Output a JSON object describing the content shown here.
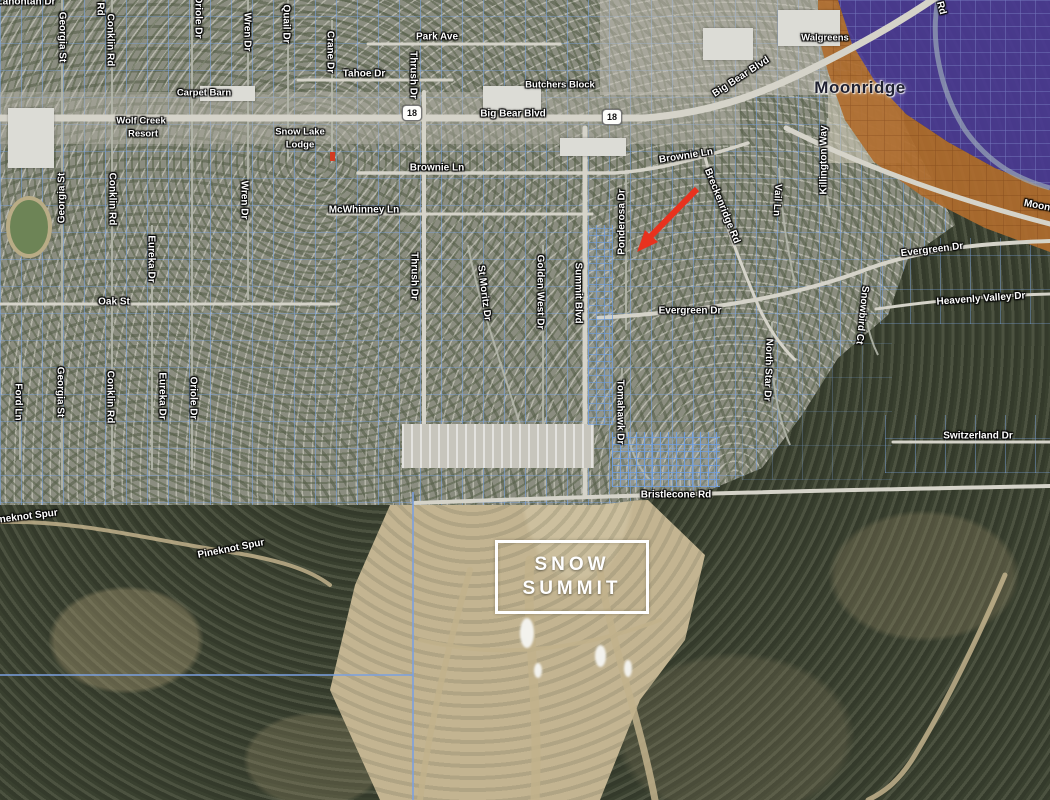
{
  "map_title": "Big Bear / Moonridge parcel map with Snow Summit",
  "colors": {
    "arrow": "#e8321e",
    "purple_zone": "#4a3a94",
    "purple_parcel_line": "#8fa0dc",
    "orange_zone": "#b06c2e",
    "orange_parcel_line": "#6b3410",
    "parcel_line": "#7aa3de",
    "boundary_line": "#7ba0e0",
    "road": "#d5d3c9",
    "label_text": "#ffffff",
    "area_label_text": "#1f2030"
  },
  "snow_summit": {
    "line1": "SNOW",
    "line2": "SUMMIT"
  },
  "highway_shields": [
    {
      "label": "18",
      "x": 412,
      "y": 113
    },
    {
      "label": "18",
      "x": 612,
      "y": 117
    }
  ],
  "labels": [
    {
      "t": "Lahontan Dr",
      "x": 26,
      "y": 2,
      "r": 0,
      "k": "street"
    },
    {
      "t": "Park Ave",
      "x": 437,
      "y": 37,
      "r": 0,
      "k": "street"
    },
    {
      "t": "Tahoe Dr",
      "x": 364,
      "y": 74,
      "r": 0,
      "k": "street"
    },
    {
      "t": "Big Bear Blvd",
      "x": 513,
      "y": 114,
      "r": 0,
      "k": "street"
    },
    {
      "t": "Big Bear Blvd",
      "x": 741,
      "y": 77,
      "r": -33,
      "k": "street"
    },
    {
      "t": "Brownie Ln",
      "x": 437,
      "y": 168,
      "r": 0,
      "k": "street"
    },
    {
      "t": "Brownie Ln",
      "x": 686,
      "y": 156,
      "r": -9,
      "k": "street"
    },
    {
      "t": "McWhinney Ln",
      "x": 364,
      "y": 210,
      "r": 0,
      "k": "street"
    },
    {
      "t": "Oak St",
      "x": 114,
      "y": 302,
      "r": 0,
      "k": "street"
    },
    {
      "t": "Evergreen Dr",
      "x": 690,
      "y": 311,
      "r": 0,
      "k": "street"
    },
    {
      "t": "Evergreen Dr",
      "x": 932,
      "y": 250,
      "r": -7,
      "k": "street"
    },
    {
      "t": "Heavenly Valley Dr",
      "x": 981,
      "y": 299,
      "r": -4,
      "k": "street"
    },
    {
      "t": "Switzerland Dr",
      "x": 978,
      "y": 436,
      "r": 0,
      "k": "street"
    },
    {
      "t": "Bristlecone Rd",
      "x": 676,
      "y": 495,
      "r": 0,
      "k": "street"
    },
    {
      "t": "Pineknot Spur",
      "x": 24,
      "y": 517,
      "r": -7,
      "k": "street"
    },
    {
      "t": "Pineknot Spur",
      "x": 231,
      "y": 549,
      "r": -11,
      "k": "street"
    },
    {
      "t": "Moonridge",
      "x": 1049,
      "y": 208,
      "r": 11,
      "k": "street"
    },
    {
      "t": "Georgia St",
      "x": 62,
      "y": 37,
      "r": 90,
      "k": "street"
    },
    {
      "t": "Conklin Rd",
      "x": 110,
      "y": 40,
      "r": 90,
      "k": "street"
    },
    {
      "t": "Rd",
      "x": 100,
      "y": 9,
      "r": 90,
      "k": "street"
    },
    {
      "t": "Oriole Dr",
      "x": 198,
      "y": 17,
      "r": 90,
      "k": "street"
    },
    {
      "t": "Wren Dr",
      "x": 247,
      "y": 32,
      "r": 90,
      "k": "street"
    },
    {
      "t": "Quail Dr",
      "x": 286,
      "y": 24,
      "r": 90,
      "k": "street"
    },
    {
      "t": "Crane Dr",
      "x": 330,
      "y": 52,
      "r": 90,
      "k": "street"
    },
    {
      "t": "Georgia St",
      "x": 62,
      "y": 198,
      "r": -90,
      "k": "street"
    },
    {
      "t": "Conklin Rd",
      "x": 112,
      "y": 199,
      "r": 90,
      "k": "street"
    },
    {
      "t": "Wren Dr",
      "x": 244,
      "y": 200,
      "r": 90,
      "k": "street"
    },
    {
      "t": "Eureka Dr",
      "x": 151,
      "y": 259,
      "r": 90,
      "k": "street"
    },
    {
      "t": "Thrush Dr",
      "x": 413,
      "y": 75,
      "r": 90,
      "k": "street"
    },
    {
      "t": "Thrush Dr",
      "x": 414,
      "y": 276,
      "r": 90,
      "k": "street"
    },
    {
      "t": "St Moritz Dr",
      "x": 484,
      "y": 293,
      "r": 83,
      "k": "street"
    },
    {
      "t": "Golden West Dr",
      "x": 540,
      "y": 292,
      "r": 90,
      "k": "street"
    },
    {
      "t": "Summit Blvd",
      "x": 578,
      "y": 293,
      "r": 90,
      "k": "street"
    },
    {
      "t": "Ponderosa Dr",
      "x": 622,
      "y": 222,
      "r": -90,
      "k": "street"
    },
    {
      "t": "Tomahawk Dr",
      "x": 620,
      "y": 412,
      "r": 90,
      "k": "street"
    },
    {
      "t": "Ford Ln",
      "x": 18,
      "y": 402,
      "r": 90,
      "k": "street"
    },
    {
      "t": "Georgia St",
      "x": 60,
      "y": 392,
      "r": 90,
      "k": "street"
    },
    {
      "t": "Conklin Rd",
      "x": 110,
      "y": 397,
      "r": 90,
      "k": "street"
    },
    {
      "t": "Eureka Dr",
      "x": 162,
      "y": 396,
      "r": 90,
      "k": "street"
    },
    {
      "t": "Oriole Dr",
      "x": 193,
      "y": 398,
      "r": 90,
      "k": "street"
    },
    {
      "t": "Vail Ln",
      "x": 777,
      "y": 200,
      "r": 93,
      "k": "street"
    },
    {
      "t": "Killington Way",
      "x": 824,
      "y": 160,
      "r": -90,
      "k": "street"
    },
    {
      "t": "Breckenridge Rd",
      "x": 722,
      "y": 206,
      "r": 68,
      "k": "street"
    },
    {
      "t": "North Star Dr",
      "x": 768,
      "y": 370,
      "r": 92,
      "k": "street"
    },
    {
      "t": "Snowbird Ct",
      "x": 862,
      "y": 315,
      "r": 96,
      "k": "street"
    },
    {
      "t": "Rd",
      "x": 941,
      "y": 8,
      "r": 75,
      "k": "street"
    },
    {
      "t": "Carpet Barn",
      "x": 204,
      "y": 93,
      "r": 0,
      "k": "poi"
    },
    {
      "t": "Butchers Block",
      "x": 560,
      "y": 85,
      "r": 0,
      "k": "poi"
    },
    {
      "t": "Walgreens",
      "x": 825,
      "y": 38,
      "r": 0,
      "k": "poi"
    },
    {
      "t": "Wolf Creek",
      "x": 141,
      "y": 121,
      "r": 0,
      "k": "poi"
    },
    {
      "t": "Resort",
      "x": 143,
      "y": 134,
      "r": 0,
      "k": "poi"
    },
    {
      "t": "Snow Lake",
      "x": 300,
      "y": 132,
      "r": 0,
      "k": "poi"
    },
    {
      "t": "Lodge",
      "x": 300,
      "y": 145,
      "r": 0,
      "k": "poi"
    },
    {
      "t": "Moonridge",
      "x": 860,
      "y": 88,
      "r": 0,
      "k": "area"
    }
  ]
}
